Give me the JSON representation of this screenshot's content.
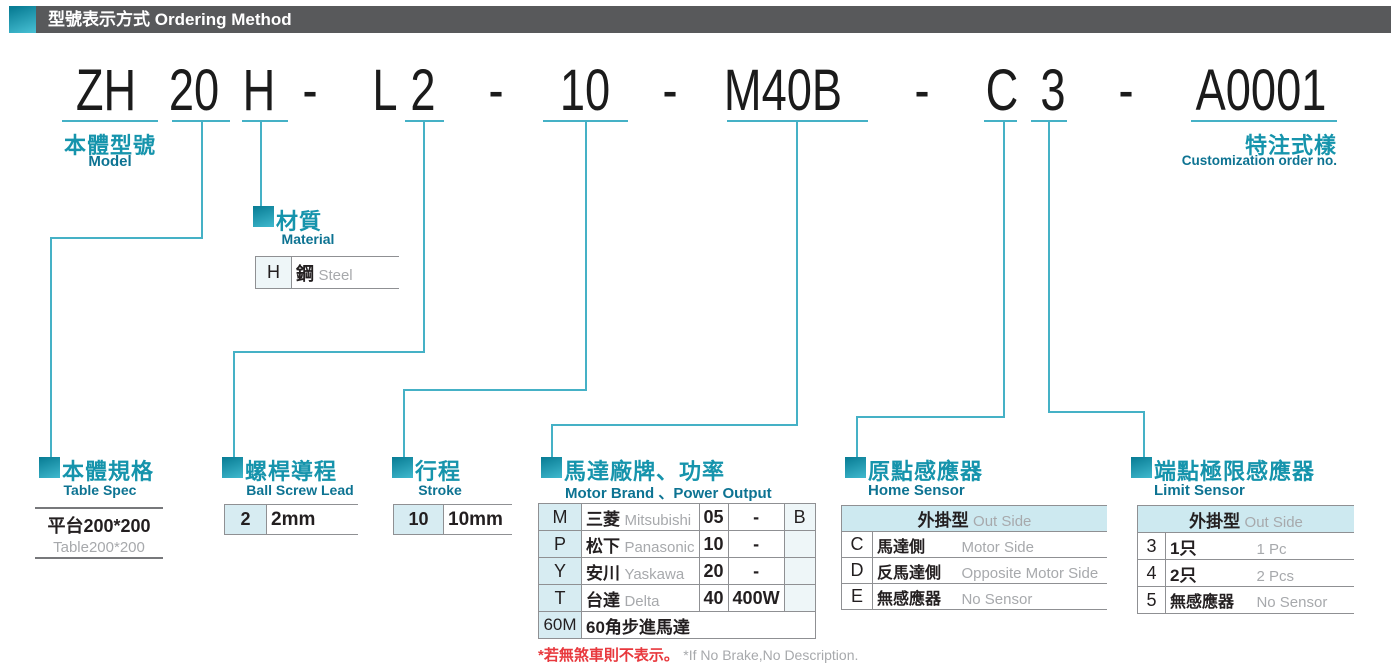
{
  "header": {
    "title_zh": "型號表示方式",
    "title_en": "Ordering Method"
  },
  "model_code": {
    "segments": [
      "ZH",
      "20",
      "H",
      "-",
      "L",
      "2",
      "-",
      "10",
      "-",
      "M40B",
      "-",
      "C",
      "3",
      "-",
      "A0001"
    ]
  },
  "labels": {
    "model": {
      "zh": "本體型號",
      "en": "Model"
    },
    "customization": {
      "zh": "特注式樣",
      "en": "Customization order no."
    }
  },
  "material": {
    "zh": "材質",
    "en": "Material",
    "row": {
      "code": "H",
      "value_zh": "鋼",
      "value_en": "Steel"
    }
  },
  "table_spec": {
    "zh": "本體規格",
    "en": "Table Spec",
    "value_zh": "平台200*200",
    "value_en": "Table200*200"
  },
  "ball_screw_lead": {
    "zh": "螺桿導程",
    "en": "Ball Screw Lead",
    "row": {
      "code": "2",
      "value": "2mm"
    }
  },
  "stroke": {
    "zh": "行程",
    "en": "Stroke",
    "row": {
      "code": "10",
      "value": "10mm"
    }
  },
  "motor": {
    "zh": "馬達廠牌、功率",
    "en": "Motor Brand 、Power Output",
    "rows": [
      {
        "code": "M",
        "brand_zh": "三菱",
        "brand_en": "Mitsubishi",
        "power_code": "05",
        "power": "-",
        "brake": "B"
      },
      {
        "code": "P",
        "brand_zh": "松下",
        "brand_en": "Panasonic",
        "power_code": "10",
        "power": "-",
        "brake": ""
      },
      {
        "code": "Y",
        "brand_zh": "安川",
        "brand_en": "Yaskawa",
        "power_code": "20",
        "power": "-",
        "brake": ""
      },
      {
        "code": "T",
        "brand_zh": "台達",
        "brand_en": "Delta",
        "power_code": "40",
        "power": "400W",
        "brake": ""
      }
    ],
    "stepper_row": {
      "code": "60M",
      "label": "60角步進馬達"
    },
    "footnote_zh": "*若無煞車則不表示。",
    "footnote_en": "*If No Brake,No Description."
  },
  "home_sensor": {
    "zh": "原點感應器",
    "en": "Home Sensor",
    "group_zh": "外掛型",
    "group_en": "Out Side",
    "rows": [
      {
        "code": "C",
        "zh": "馬達側",
        "en": "Motor Side"
      },
      {
        "code": "D",
        "zh": "反馬達側",
        "en": "Opposite Motor Side"
      },
      {
        "code": "E",
        "zh": "無感應器",
        "en": "No Sensor"
      }
    ]
  },
  "limit_sensor": {
    "zh": "端點極限感應器",
    "en": "Limit Sensor",
    "group_zh": "外掛型",
    "group_en": "Out Side",
    "rows": [
      {
        "code": "3",
        "zh": "1只",
        "en": "1 Pc"
      },
      {
        "code": "4",
        "zh": "2只",
        "en": "2 Pcs"
      },
      {
        "code": "5",
        "zh": "無感應器",
        "en": "No Sensor"
      }
    ]
  },
  "colors": {
    "teal": "#1694ac",
    "teal_dark": "#0d7392",
    "line": "#45b1c6",
    "cell_bg": "#d7ecf2",
    "group_header_bg": "#cde9f0",
    "bar_bg": "#58595b",
    "red": "#e8383d",
    "gray_text": "#a7a9ac",
    "black_text": "#231f20",
    "border": "#8f9093"
  }
}
